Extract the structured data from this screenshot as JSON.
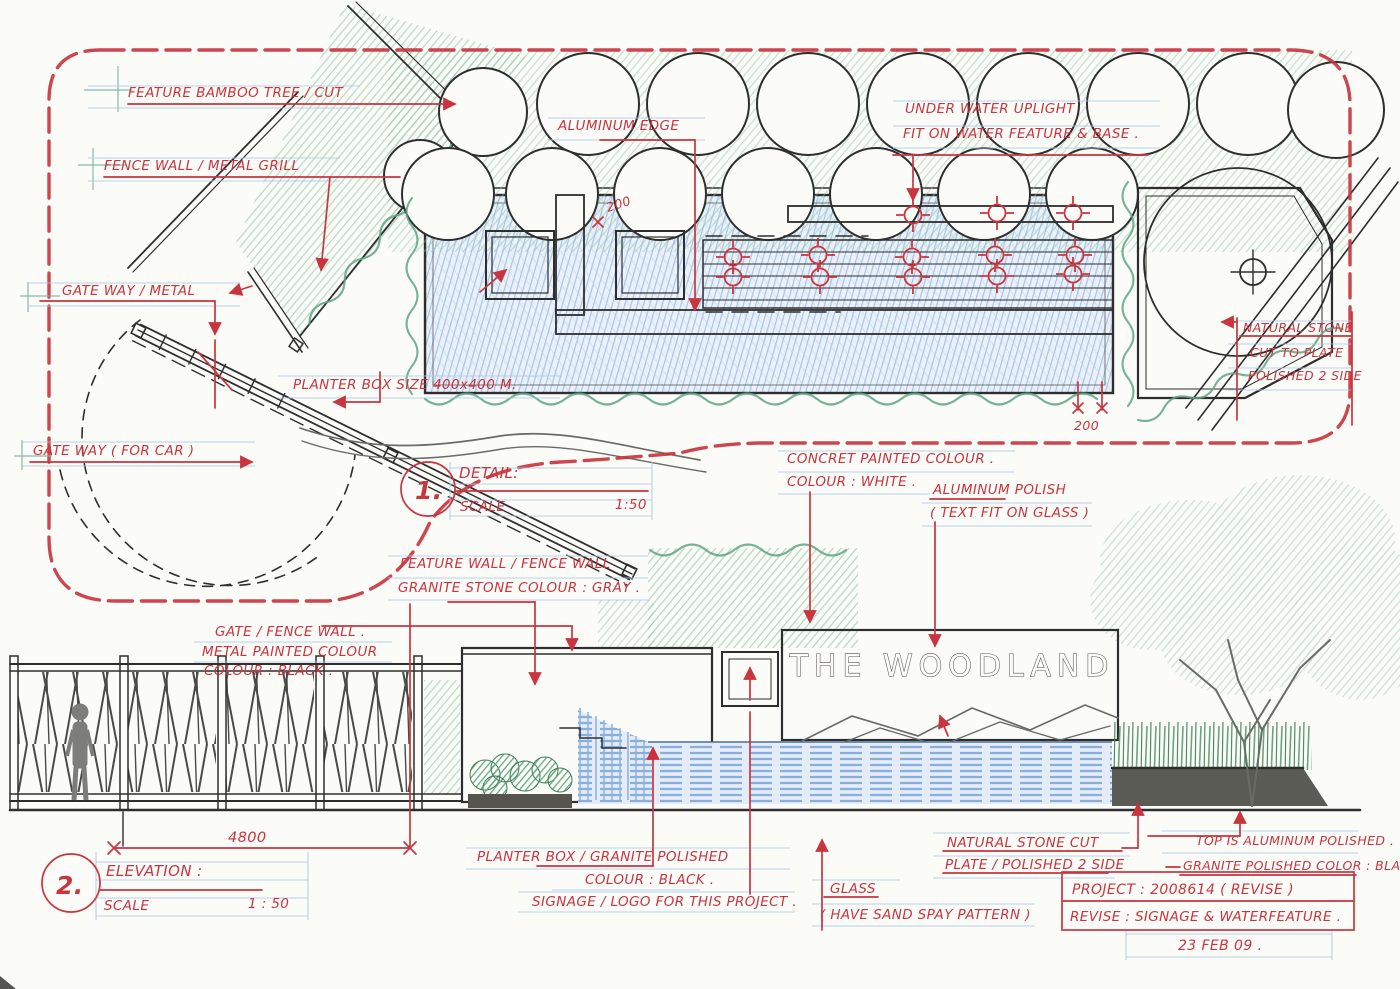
{
  "colors": {
    "annotation_red": "#c9353f",
    "guide_blue": "#a9c7e6",
    "pencil_green": "#5ea583",
    "water_blue": "#7ea8d8",
    "ink": "#2e2e2e"
  },
  "plan": {
    "callouts": {
      "feature_bamboo": "FEATURE BAMBOO TREE / CUT",
      "fence_wall": "FENCE WALL / METAL GRILL",
      "gateway_metal": "GATE WAY / METAL",
      "gateway_car": "GATE WAY ( FOR CAR )",
      "planter_box": "PLANTER BOX   SIZE   400x400 M.",
      "aluminum_edge": "ALUMINUM EDGE",
      "uplight_line1": "UNDER WATER   UPLIGHT",
      "uplight_line2": "FIT ON WATER FEATURE & BASE .",
      "natural_stone_line1": "NATURAL STONE",
      "natural_stone_line2": "CUT TO PLATE",
      "natural_stone_line3": "POLISHED  2 SIDE"
    },
    "dims": {
      "edge": "200",
      "corner": "200"
    },
    "titleblock": {
      "number": "1.",
      "title": "DETAIL:",
      "scale_label": "SCALE",
      "scale_value": "1:50"
    }
  },
  "elevation": {
    "signage_text": "THE WOODLAND",
    "callouts": {
      "concrete_line1": "CONCRET PAINTED COLOUR .",
      "concrete_line2": "COLOUR :  WHITE .",
      "aluminum_polish_line1": "ALUMINUM POLISH",
      "aluminum_polish_line2": "( TEXT FIT ON GLASS )",
      "feature_wall_line1": "FEATURE WALL / FENCE WALL",
      "feature_wall_line2": "GRANITE STONE  COLOUR : GRAY .",
      "gate_fence_line1": "GATE /  FENCE WALL .",
      "gate_fence_line2": "METAL PAINTED COLOUR",
      "gate_fence_line3": "COLOUR :  BLACK .",
      "planter_granite_line1": "PLANTER BOX / GRANITE POLISHED",
      "planter_granite_line2": "COLOUR :  BLACK .",
      "signage_logo": "SIGNAGE / LOGO FOR THIS PROJECT .",
      "glass_line1": "GLASS",
      "glass_line2": "( HAVE SAND SPAY PATTERN )",
      "stone_cut_line1": "NATURAL STONE CUT",
      "stone_cut_line2": "PLATE / POLISHED  2 SIDE",
      "top_aluminum": "TOP IS ALUMINUM POLISHED .",
      "granite_black": "GRANITE POLISHED  COLOR : BLACK"
    },
    "dims": {
      "width": "4800"
    },
    "titleblock": {
      "number": "2.",
      "title": "ELEVATION :",
      "scale_label": "SCALE",
      "scale_value": "1 : 50"
    }
  },
  "project": {
    "project_line": "PROJECT :  2008614  ( REVISE )",
    "revise_line": "REVISE :  SIGNAGE  &  WATERFEATURE .",
    "date": "23  FEB  09 ."
  }
}
